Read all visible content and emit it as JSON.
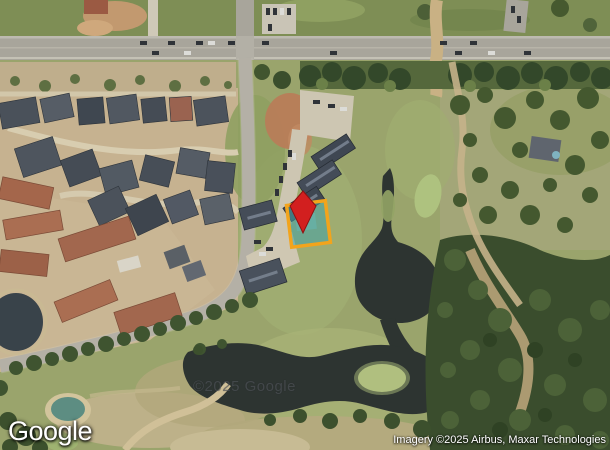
{
  "map": {
    "view_type": "satellite-imagery"
  },
  "branding": {
    "logo_text": "Google"
  },
  "watermark": {
    "text": "©2025 Google"
  },
  "attribution": {
    "text": "Imagery ©2025 Airbus, Maxar Technologies"
  },
  "marker": {
    "pin_color": "#d21f1f",
    "pin_stroke": "#8e1111"
  },
  "parcel": {
    "outline_color": "#f2a41c",
    "fill_color": "#3fa3a8",
    "fill_opacity": "0.55"
  }
}
